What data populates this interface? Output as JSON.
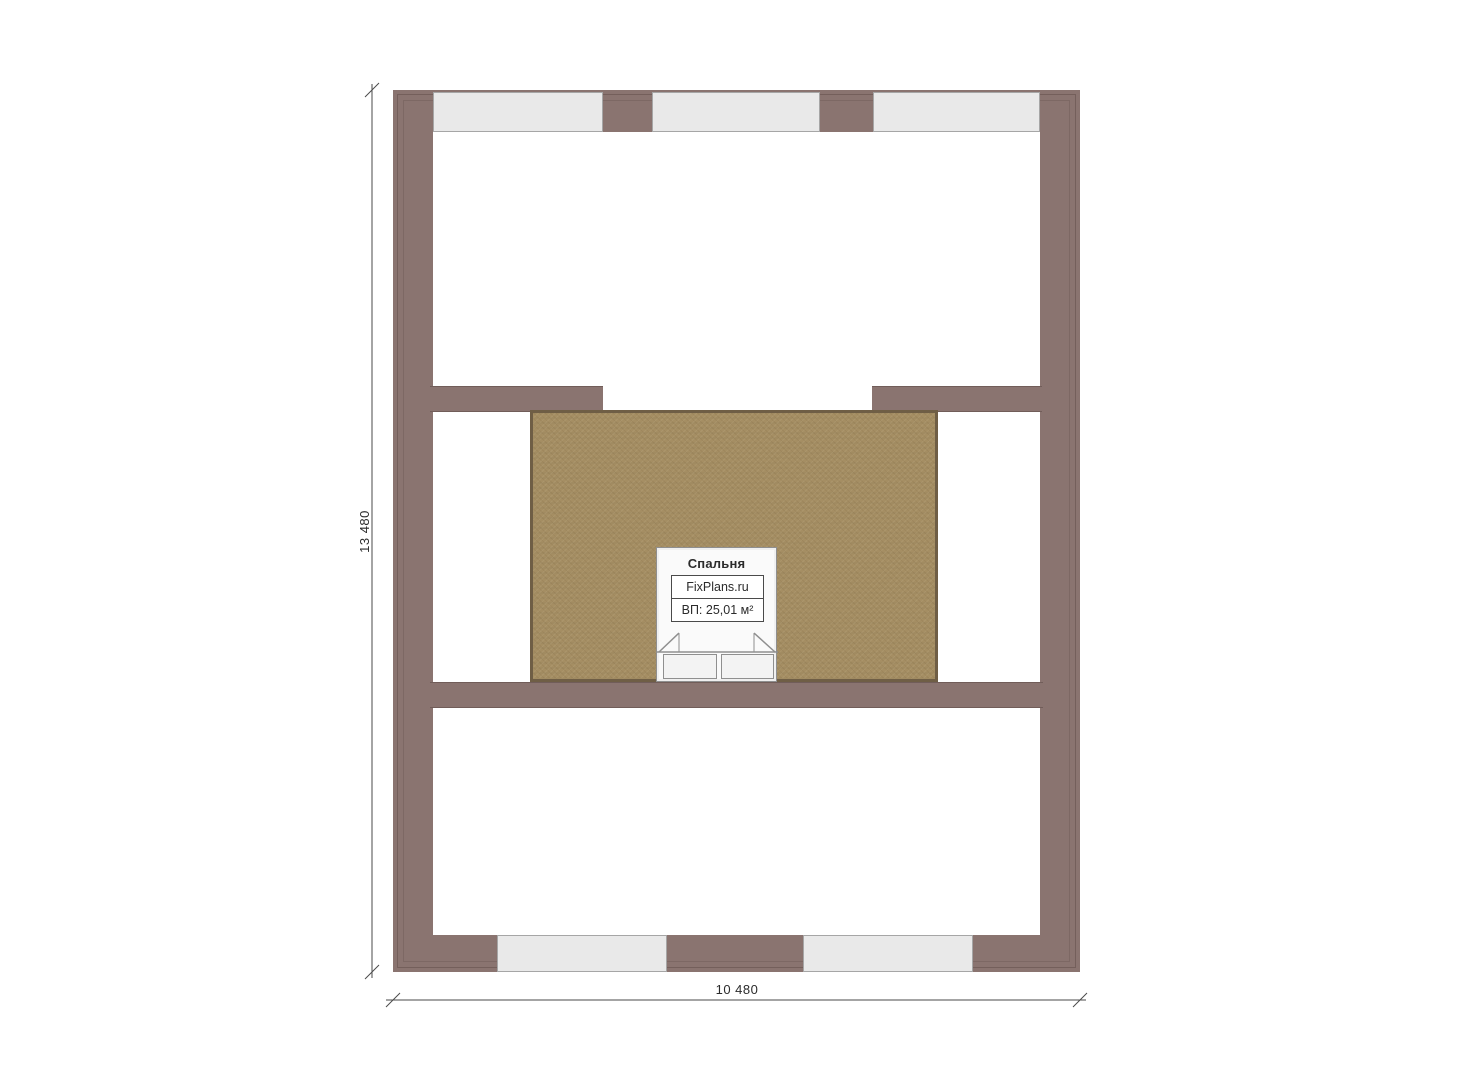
{
  "title": "Floor plan drawing",
  "colors": {
    "wall": "#8a7470",
    "wall_edge": "#75605c",
    "window_fill": "#e9e9e9",
    "window_border": "#a6a6a6",
    "floor_fill": "#a58e63",
    "floor_border": "#6f5e45",
    "bed_outline": "#8f8f8f",
    "dim_line": "#4a4a4a",
    "text": "#2b2b2b"
  },
  "room_label": {
    "name": "Спальня",
    "site": "FixPlans.ru",
    "area": "ВП: 25,01 м²"
  },
  "dimensions": {
    "vertical": "13 480",
    "horizontal": "10 480"
  }
}
